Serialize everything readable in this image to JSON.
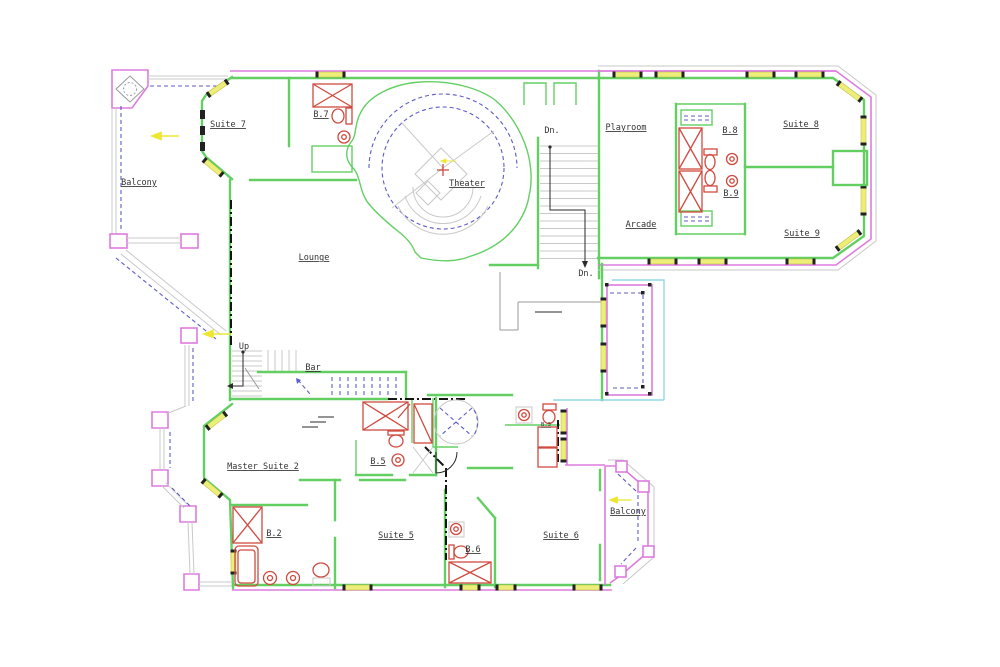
{
  "plan": {
    "type": "floor-plan",
    "labels": {
      "balcony_upper": "Balcony",
      "suite7": "Suite 7",
      "b7": "B.7",
      "theater": "Theater",
      "dn_top": "Dn.",
      "playroom": "Playroom",
      "b8": "B.8",
      "suite8": "Suite 8",
      "arcade": "Arcade",
      "b9": "B.9",
      "suite9": "Suite 9",
      "dn_bottom": "Dn.",
      "lounge": "Lounge",
      "up": "Up",
      "bar": "Bar",
      "master_suite2": "Master Suite 2",
      "b5": "B.5",
      "b3": "B.3",
      "b2": "B.2",
      "suite5": "Suite 5",
      "b6": "B.6",
      "suite6": "Suite 6",
      "balcony_lower": "Balcony"
    },
    "colors": {
      "wall_green": "#63cf63",
      "railing_magenta": "#dd7bdd",
      "window_yellow": "#eded7a",
      "ceiling_dashed_blue": "#5c5cc9",
      "deck_cyan": "#8fd8e8",
      "fixture_red": "#cf4a3f",
      "tread_gray": "#c9c9c9",
      "arrow_yellow": "#ede732",
      "label_text": "#333333"
    }
  }
}
